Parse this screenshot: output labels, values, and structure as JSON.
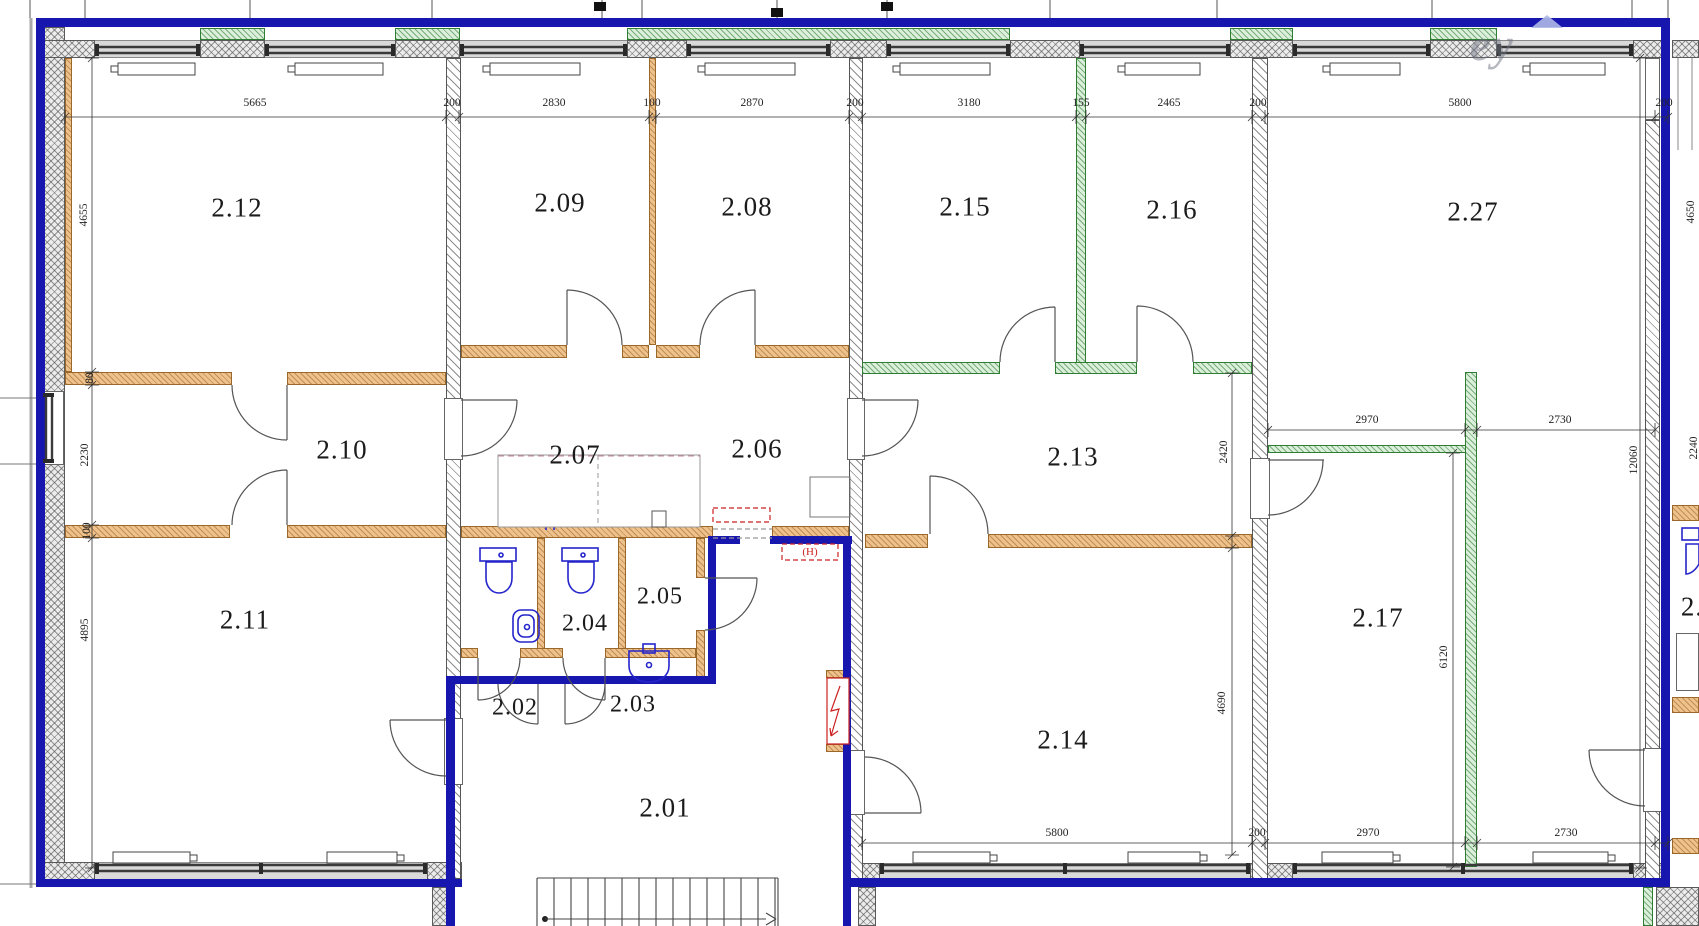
{
  "plan": {
    "type": "architectural-floor-plan",
    "floor": "2",
    "units": "mm"
  },
  "room_labels": [
    {
      "t": "2.12",
      "x": 237,
      "y": 208
    },
    {
      "t": "2.09",
      "x": 560,
      "y": 203
    },
    {
      "t": "2.08",
      "x": 747,
      "y": 207
    },
    {
      "t": "2.15",
      "x": 965,
      "y": 207
    },
    {
      "t": "2.16",
      "x": 1172,
      "y": 210
    },
    {
      "t": "2.27",
      "x": 1473,
      "y": 212
    },
    {
      "t": "2.10",
      "x": 342,
      "y": 450
    },
    {
      "t": "2.07",
      "x": 575,
      "y": 455
    },
    {
      "t": "2.06",
      "x": 757,
      "y": 449
    },
    {
      "t": "2.13",
      "x": 1073,
      "y": 457
    },
    {
      "t": "2.11",
      "x": 245,
      "y": 620
    },
    {
      "t": "2.04",
      "x": 585,
      "y": 624,
      "s": 24
    },
    {
      "t": "2.05",
      "x": 660,
      "y": 597,
      "s": 24
    },
    {
      "t": "2.02",
      "x": 515,
      "y": 708,
      "s": 24
    },
    {
      "t": "2.03",
      "x": 633,
      "y": 705,
      "s": 24
    },
    {
      "t": "2.01",
      "x": 665,
      "y": 808
    },
    {
      "t": "2.14",
      "x": 1063,
      "y": 740
    },
    {
      "t": "2.17",
      "x": 1378,
      "y": 618
    },
    {
      "t": "2.",
      "x": 1692,
      "y": 607
    }
  ],
  "dim_labels": [
    {
      "t": "5665",
      "x": 255,
      "y": 103
    },
    {
      "t": "200",
      "x": 452,
      "y": 103
    },
    {
      "t": "2830",
      "x": 554,
      "y": 103
    },
    {
      "t": "100",
      "x": 652,
      "y": 103
    },
    {
      "t": "2870",
      "x": 752,
      "y": 103
    },
    {
      "t": "200",
      "x": 855,
      "y": 103
    },
    {
      "t": "3180",
      "x": 969,
      "y": 103
    },
    {
      "t": "155",
      "x": 1081,
      "y": 103
    },
    {
      "t": "2465",
      "x": 1169,
      "y": 103
    },
    {
      "t": "200",
      "x": 1258,
      "y": 103
    },
    {
      "t": "5800",
      "x": 1460,
      "y": 103
    },
    {
      "t": "200",
      "x": 1664,
      "y": 103
    },
    {
      "t": "4655",
      "x": 84,
      "y": 215,
      "r": 1
    },
    {
      "t": "80",
      "x": 90,
      "y": 378,
      "r": 1
    },
    {
      "t": "2230",
      "x": 85,
      "y": 455,
      "r": 1
    },
    {
      "t": "100",
      "x": 87,
      "y": 531,
      "r": 1
    },
    {
      "t": "4895",
      "x": 85,
      "y": 630,
      "r": 1
    },
    {
      "t": "2420",
      "x": 1224,
      "y": 452,
      "r": 1
    },
    {
      "t": "4690",
      "x": 1222,
      "y": 703,
      "r": 1
    },
    {
      "t": "6120",
      "x": 1444,
      "y": 657,
      "r": 1
    },
    {
      "t": "12060",
      "x": 1634,
      "y": 460,
      "r": 1
    },
    {
      "t": "4650",
      "x": 1691,
      "y": 212,
      "r": 1
    },
    {
      "t": "2240",
      "x": 1694,
      "y": 448,
      "r": 1
    },
    {
      "t": "2970",
      "x": 1367,
      "y": 420
    },
    {
      "t": "2730",
      "x": 1560,
      "y": 420
    },
    {
      "t": "5800",
      "x": 1057,
      "y": 833
    },
    {
      "t": "200",
      "x": 1257,
      "y": 833
    },
    {
      "t": "2970",
      "x": 1368,
      "y": 833
    },
    {
      "t": "2730",
      "x": 1566,
      "y": 833
    }
  ],
  "annotations": {
    "shaft": "(H)",
    "watermark": "ey"
  },
  "colors": {
    "boundary_blue": "#1717b0",
    "partition_orange": "#eec28c",
    "partition_green": "#dcefdc",
    "fixture_blue": "#2525cc",
    "alert_red": "#cc2020"
  }
}
